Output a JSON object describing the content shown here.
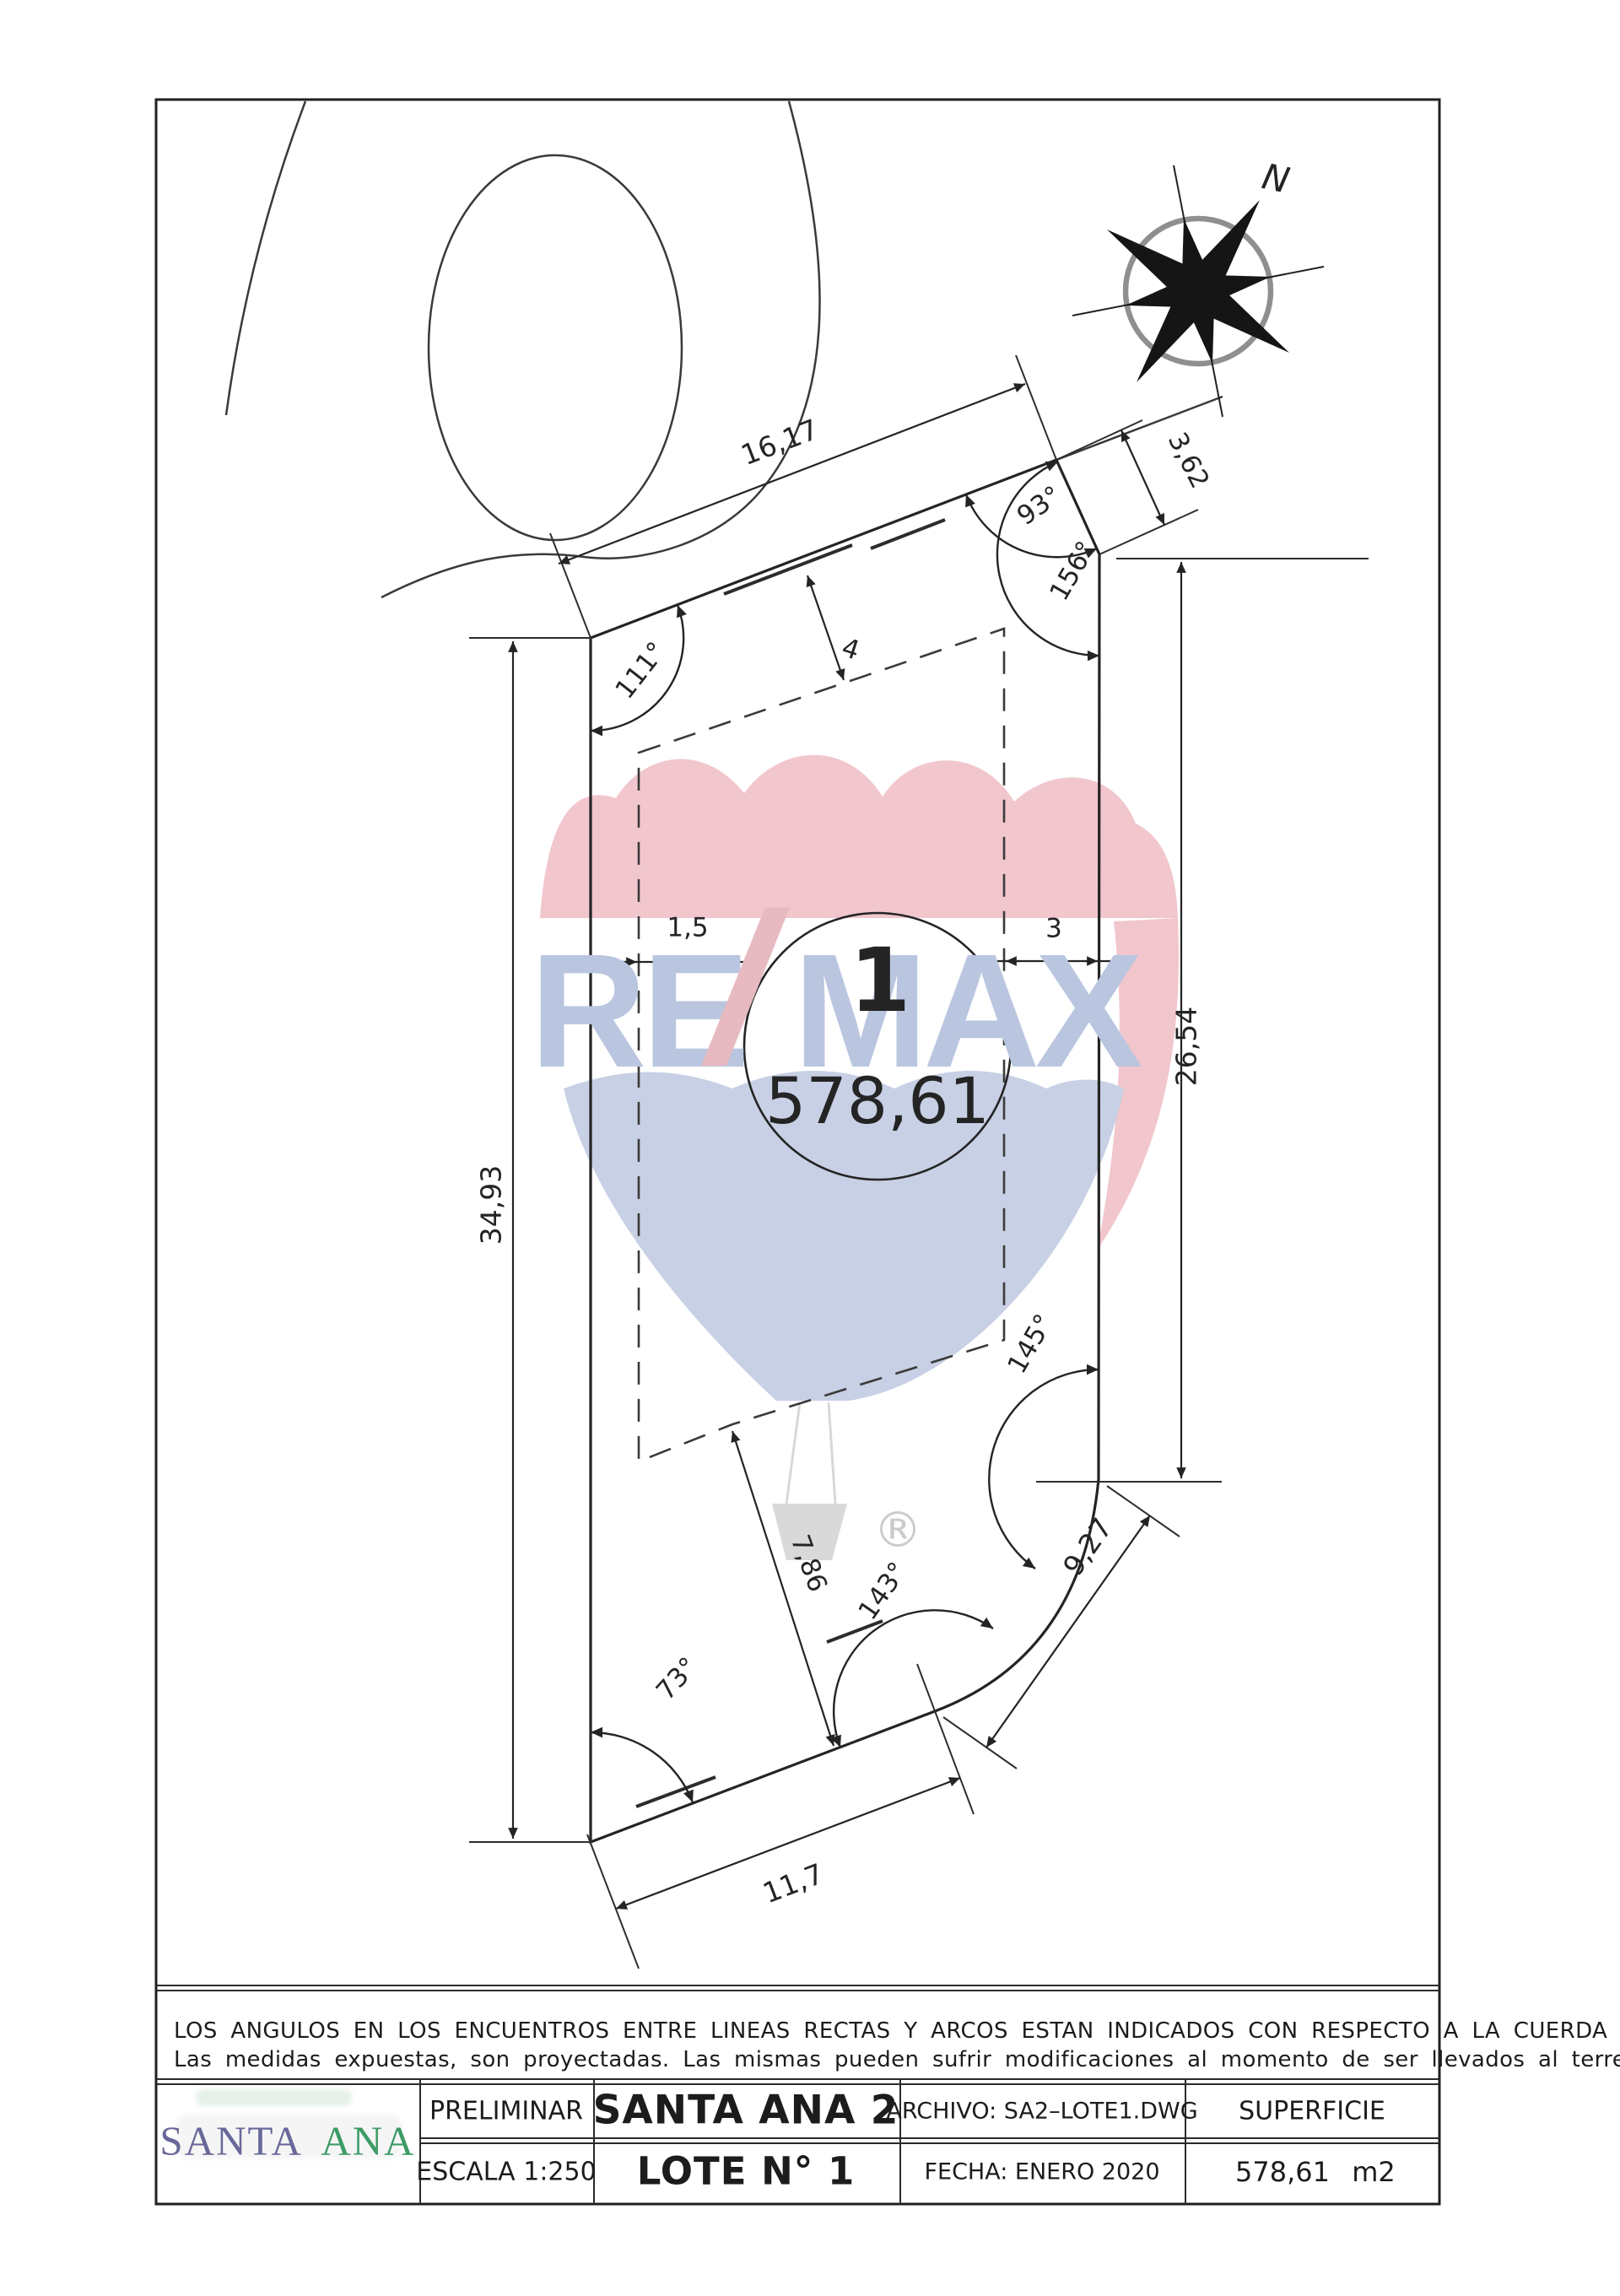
{
  "plan": {
    "north_label": "N",
    "lot_circle": {
      "number": "1",
      "area": "578,61"
    },
    "dims": {
      "top": "16,17",
      "bevel": "3,62",
      "right": "26,54",
      "left": "34,93",
      "bottom": "11,7",
      "arc_chord": "9,27",
      "inner": "7,86",
      "setback_top": "4",
      "setback_left": "1,5",
      "setback_right": "3"
    },
    "angles": {
      "top_left": "111°",
      "top_right": "93°",
      "top_right_lower": "156°",
      "arc_upper": "145°",
      "arc_lower": "143°",
      "bottom_left": "73°"
    },
    "watermark": {
      "re": "RE",
      "slash": "/",
      "max": "MAX",
      "registered": "®"
    }
  },
  "notes": {
    "line1": "LOS ANGULOS EN LOS ENCUENTROS ENTRE LINEAS RECTAS Y ARCOS ESTAN INDICADOS CON RESPECTO A LA CUERDA DEL ARCO.-",
    "line2": "Las medidas expuestas, son proyectadas. Las mismas pueden sufrir modificaciones al momento de ser llevados al terreno"
  },
  "title_block": {
    "logo": {
      "word1": "SANTA",
      "word2": "ANA"
    },
    "status": "PRELIMINAR",
    "project": "SANTA ANA 2",
    "file": "ARCHIVO: SA2–LOTE1.DWG",
    "area_header": "SUPERFICIE",
    "scale": "ESCALA 1:250",
    "lot": "LOTE N° 1",
    "date": "FECHA: ENERO 2020",
    "area_value": "578,61",
    "area_unit": "m2"
  },
  "colors": {
    "ink": "#232323",
    "logo_blue": "#68689a",
    "logo_green": "#3c9b66",
    "remax_letter_blue": "#bac6df",
    "remax_red": "#f2c6cd",
    "balloon_blue": "#c7d0e4"
  }
}
